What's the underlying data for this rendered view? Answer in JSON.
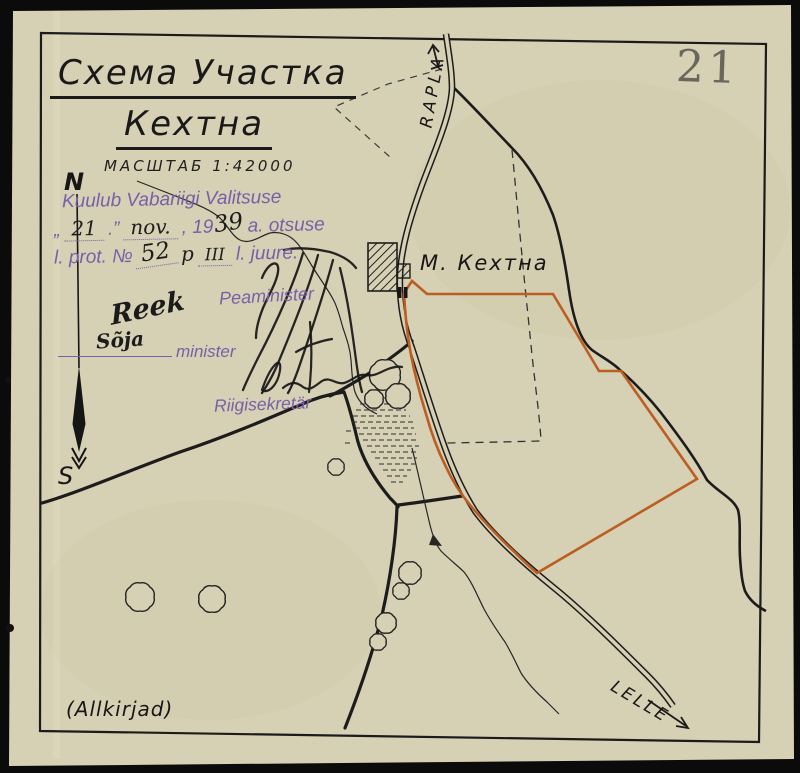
{
  "page": {
    "number": "21"
  },
  "title": {
    "line1": "Схема Участка",
    "line2": "Кехтна",
    "scale": "МАСШТАБ 1:42000"
  },
  "stamp": {
    "line1": "Kuulub Vabariigi Valitsuse",
    "open_quote": "„",
    "day": "21",
    "close_quote": ".”",
    "month": "nov.",
    "year_prefix": ", 19",
    "year_written": "39",
    "line2_tail": "a. otsuse",
    "line3_prefix": "l. prot. №",
    "protocol": "52",
    "point_label": "p",
    "point": "III",
    "line3_tail": "l. juure."
  },
  "signatures": {
    "peaminister_label": "Peaminister",
    "minister_handwritten": "Sõja",
    "minister_signature": "Reek",
    "minister_label": "minister",
    "riigisekretar_label": "Riigisekretär",
    "note": "(Allkirjad)"
  },
  "map": {
    "labels": {
      "road_north": "RAPLA",
      "road_south": "LELLE",
      "manor": "М. Кехтна",
      "compass_north": "N",
      "compass_south": "S"
    },
    "colors": {
      "parcel_boundary": "#bc5e22",
      "ink": "#1c1c1c",
      "stamp_ink": "#7a5fa8",
      "paper": "#d6d0b4"
    }
  }
}
